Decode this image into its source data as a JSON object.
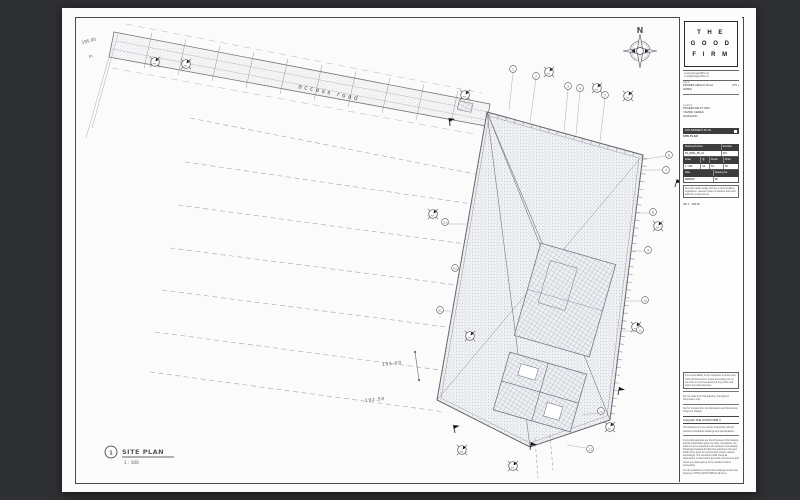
{
  "colors": {
    "background": "#2f3033",
    "paper": "#fbfbfb",
    "line_dark": "#4a4a4a",
    "bar_dark": "#3c3c3c",
    "stipple": "#8d95a5"
  },
  "title_block": {
    "logo_lines": [
      "T H E",
      "G O O D",
      "F I R M"
    ],
    "contact_lines": [
      "w   www.thegoodfirm.co",
      "e   info@thegoodfirm.co"
    ],
    "client_label": "Client:",
    "client_name": "PRUEBA AMALO VILLA",
    "client_code": "( PV )",
    "client_line2": "OZMIA",
    "location_label": "Location:",
    "location_lines": [
      "PRUEBA MILKY WAY",
      "YAMPAI CERES",
      "GURGAON"
    ],
    "status_bar": "10% MOMENT PLAN",
    "drawing_title": "SITE PLAN",
    "table": {
      "drawing_number_label": "Drawing Number",
      "revision_label": "Revision",
      "drawing_number": "PV_DWG_SP_01",
      "revision": "001",
      "scale_label": "Scale",
      "at_label": "@",
      "drawn_label": "Drawn",
      "check_label": "Chkd",
      "scale": "1 : 100",
      "at": "A1",
      "drawn": "TS",
      "check": "JD",
      "date_label": "Date",
      "dwg_label": "Drawing No.",
      "date": "06/05/23",
      "dwg": "SP"
    },
    "note": "All works shall comply with the current building regulations, relevant codes of practice and local authority requirements.",
    "scale_note": "SP 1 : 100.00",
    "disclaimer_box": "It is responsibility of the contractor to check and verify all dimensions, levels and setting out on site prior to commencement of any works and report any discrepancies.",
    "disclaimers": [
      "Do not scale from this drawing. Use figured dimensions only.",
      "Not for construction. All information and dimensions subject to change."
    ],
    "copyright": "Copyright THE GOOD FIRM ©",
    "fine_print": [
      "This drawing is to be read in conjunction with all relevant consultants drawings and specifications.",
      "If any discrepancies are found between this drawing and the information given by other consultants, the matter is to be reported to the architect immediately. Drawings prepared for planning purposes only and shall not be used for construction unless marked accordingly. The contractor shall check all dimensions on site before any work commences and report any discrepancy to the architect before proceeding.",
      "For the avoidance of doubt this drawing remains the property of THE GOOD FIRM at all times."
    ]
  },
  "drawing": {
    "north_label": "N",
    "road_label": "access road",
    "level_top": "195.00",
    "level_top_unit": "m",
    "contour_label_1": "195.00",
    "contour_label_2": "192.50",
    "viewport": {
      "number": "1",
      "title": "SITE PLAN",
      "scale": "1 : 100"
    },
    "callouts": [
      "1",
      "2",
      "3",
      "4",
      "5",
      "6",
      "7",
      "8",
      "9",
      "10",
      "11",
      "03",
      "02",
      "01",
      "12",
      "13"
    ]
  }
}
